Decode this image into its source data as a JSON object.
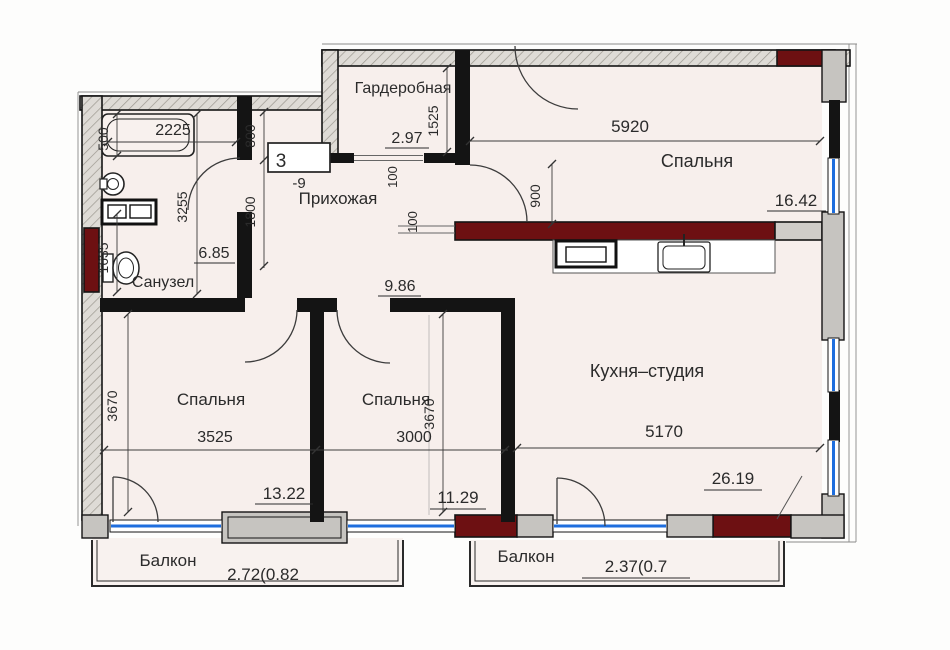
{
  "colors": {
    "load_bearing_wall": "#6d1012",
    "window": "#1e6ede",
    "floor": "#f7efec"
  },
  "rooms": {
    "bathroom": {
      "label": "Санузел",
      "area": "6.85"
    },
    "hallway": {
      "label": "Прихожая",
      "area": "9.86"
    },
    "wardrobe": {
      "label": "Гардеробная",
      "area": "2.97"
    },
    "bedroom_right": {
      "label": "Спальня",
      "area": "16.42"
    },
    "bedroom_left": {
      "label": "Спальня",
      "area": "13.22"
    },
    "bedroom_middle": {
      "label": "Спальня",
      "area": "11.29"
    },
    "kitchen": {
      "label": "Кухня–студия",
      "area": "26.19"
    },
    "balcony_left": {
      "label": "Балкон",
      "area": "2.72(0.82"
    },
    "balcony_right": {
      "label": "Балкон",
      "area": "2.37(0.7"
    }
  },
  "dimensions": {
    "bathroom_width": "2225",
    "bathroom_depth": "3255",
    "bathtub": "500",
    "bathroom_side": "1635",
    "hall_niche_top": "800",
    "hall_niche_bottom": "1800",
    "wardrobe_depth": "1525",
    "partition_a": "100",
    "partition_b": "100",
    "bedroom_right_width": "5920",
    "bedroom_right_door": "900",
    "bedroom_left_width": "3525",
    "bedroom_left_depth": "3670",
    "bedroom_middle_width": "3000",
    "bedroom_middle_depth": "3670",
    "kitchen_width": "5170"
  },
  "markers": {
    "unit_number": "3",
    "level_mark": "-9"
  }
}
